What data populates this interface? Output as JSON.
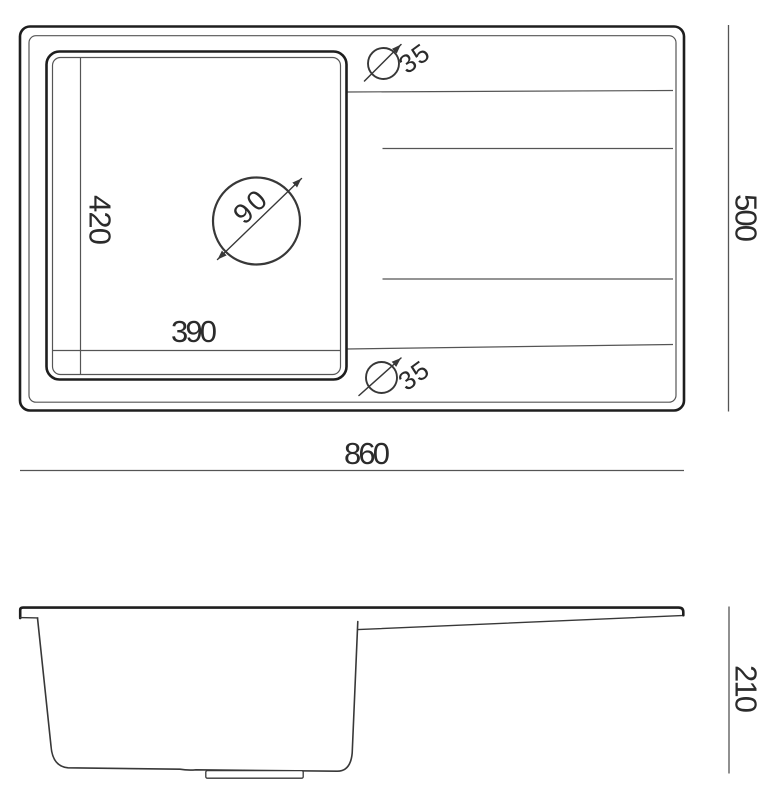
{
  "colors": {
    "background": "#ffffff",
    "line_heavy": "#1e1e1e",
    "line_medium": "#383838",
    "line_light": "#555555",
    "text": "#2b2b2b"
  },
  "top_view": {
    "overall_width": "860",
    "overall_depth": "500",
    "bowl_width": "390",
    "bowl_depth": "420",
    "drain_diameter": "90",
    "top_hole_diameter": "35",
    "bottom_hole_diameter": "35"
  },
  "side_view": {
    "height": "210"
  }
}
